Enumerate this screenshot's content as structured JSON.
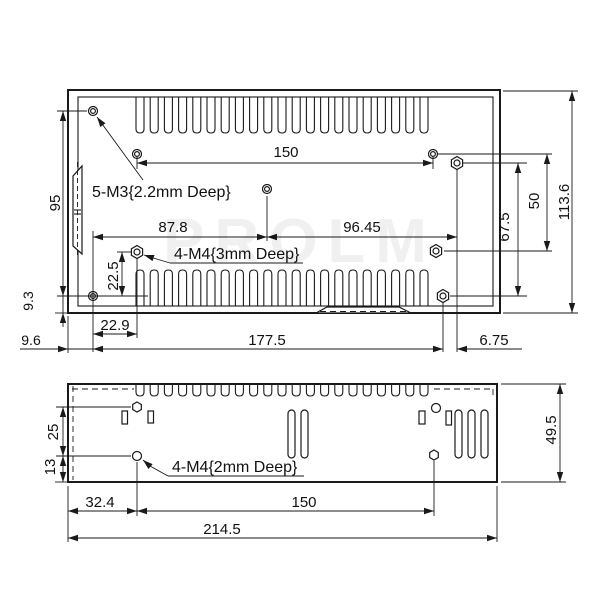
{
  "watermark": "PROLM",
  "top_view": {
    "note_m3": "5-M3{2.2mm Deep}",
    "note_m4": "4-M4{3mm Deep}",
    "dim_width_holes": "150",
    "dim_95": "95",
    "dim_87_8": "87.8",
    "dim_96_45": "96.45",
    "dim_50": "50",
    "dim_67_5": "67.5",
    "dim_113_6": "113.6",
    "dim_22_5": "22.5",
    "dim_22_9": "22.9",
    "dim_177_5": "177.5",
    "dim_9_6": "9.6",
    "dim_9_3": "9.3",
    "dim_6_75": "6.75"
  },
  "side_view": {
    "note_m4": "4-M4{2mm Deep}",
    "dim_25": "25",
    "dim_13": "13",
    "dim_32_4": "32.4",
    "dim_150": "150",
    "dim_214_5": "214.5",
    "dim_49_5": "49.5"
  }
}
